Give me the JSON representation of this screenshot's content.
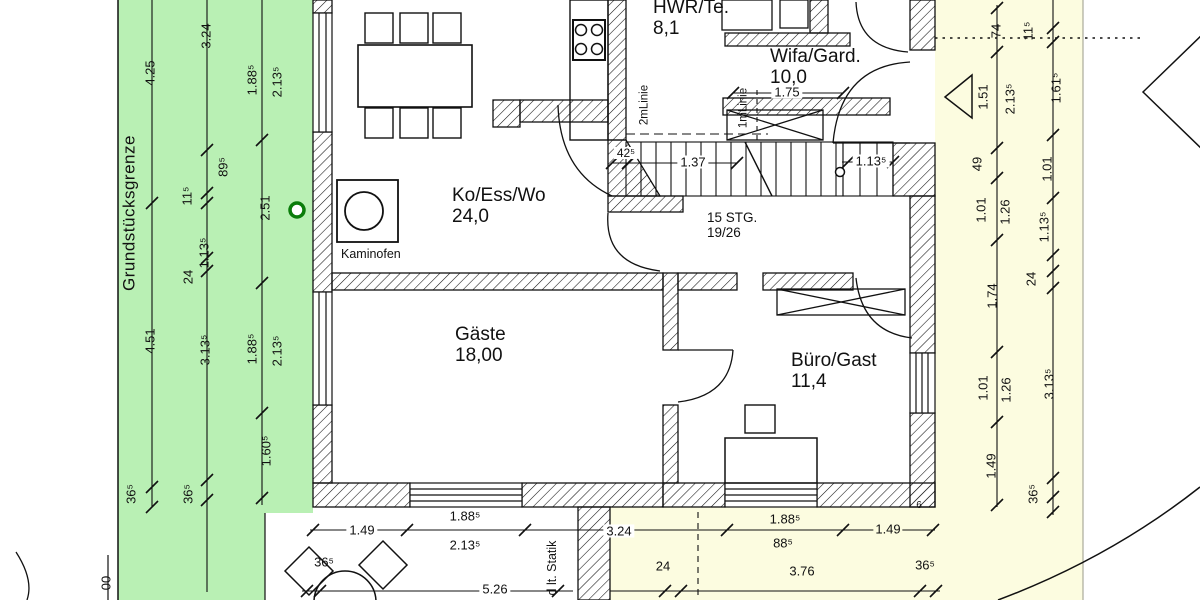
{
  "colors": {
    "site_green": "#b9f0b4",
    "site_yellow": "#fcfce0",
    "line_black": "#111111",
    "boundary_circle_green": "#0a7d0a"
  },
  "site": {
    "boundary_label": "Grundstücksgrenze",
    "partial_number": "00",
    "statik_note": "d lt. Statik",
    "corner_mark": "6"
  },
  "rooms": {
    "koesswo": {
      "name": "Ko/Ess/Wo",
      "area": "24,0"
    },
    "gaeste": {
      "name": "Gäste",
      "area": "18,00"
    },
    "hwr": {
      "name": "HWR/Te.",
      "area": "8,1"
    },
    "wifa": {
      "name": "Wifa/Gard.",
      "area": "10,0"
    },
    "buero": {
      "name": "Büro/Gast",
      "area": "11,4"
    }
  },
  "stairs": {
    "line1": "15 STG.",
    "line2": "19/26"
  },
  "furniture": {
    "kaminofen_label": "Kaminofen"
  },
  "guides": {
    "two_m": "2mLinie",
    "one_m": "1mLinie"
  },
  "dims": {
    "left_outer": [
      "4.25",
      "4.51",
      "36⁵"
    ],
    "left_mid": [
      "3.24",
      "89⁵",
      "11⁵",
      "1.13⁵",
      "24",
      "3.13⁵",
      "36⁵"
    ],
    "left_inner": [
      "1.88⁵",
      "2.13⁵",
      "2.51",
      "1.88⁵",
      "2.13⁵",
      "1.60⁵"
    ],
    "right_inner": [
      "74",
      "1.51",
      "2.13⁵",
      "49",
      "1.01",
      "1.26",
      "1.74",
      "1.01",
      "1.26",
      "1.49"
    ],
    "right_outer": [
      "11⁵",
      "1.61⁵",
      "1.01",
      "1.13⁵",
      "24",
      "3.13⁵",
      "36⁵"
    ],
    "bottom_row1": [
      "1.49",
      "1.88⁵",
      "2.13⁵",
      "3.24",
      "1.88⁵",
      "88⁵",
      "1.49"
    ],
    "bottom_row2": [
      "36⁵",
      "5.26",
      "24",
      "3.76",
      "36⁵"
    ],
    "plan_inner": [
      "42⁵",
      "1.37",
      "1.13⁵",
      "1.75"
    ]
  }
}
